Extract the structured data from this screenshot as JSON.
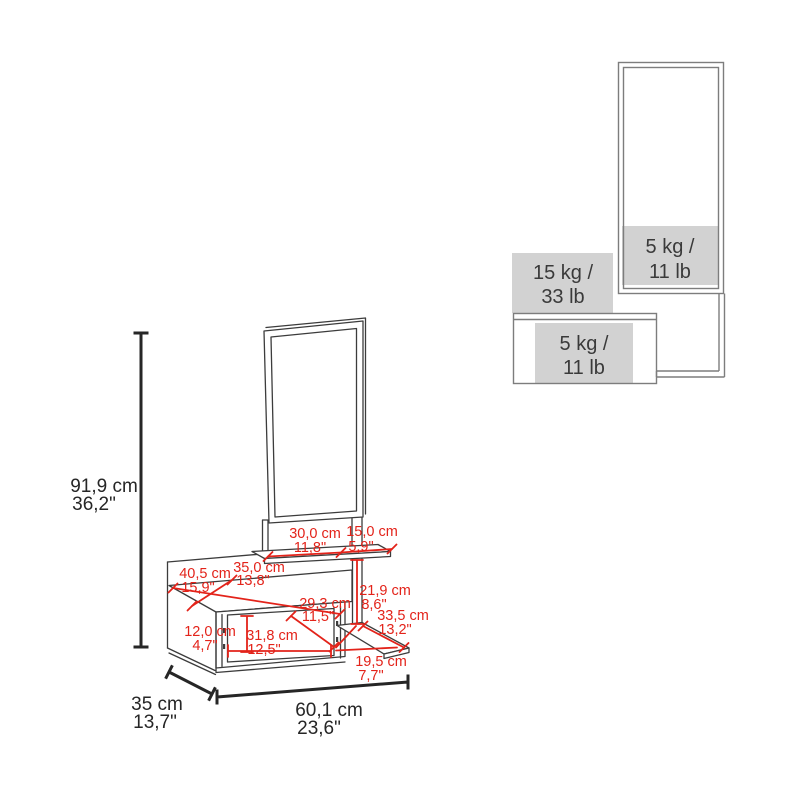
{
  "capacity_view": {
    "mirror_load": {
      "line1": "5 kg /",
      "line2": "11 lb"
    },
    "top_load": {
      "line1": "15 kg /",
      "line2": "33 lb"
    },
    "shelf_load": {
      "line1": "5 kg /",
      "line2": "11 lb"
    }
  },
  "dimension_view": {
    "height": {
      "cm": "91,9 cm",
      "in": "36,2\""
    },
    "depth": {
      "cm": "35 cm",
      "in": "13,7\""
    },
    "width": {
      "cm": "60,1 cm",
      "in": "23,6\""
    },
    "shelf_section_left": {
      "cm": "30,0 cm",
      "in": "11,8\""
    },
    "shelf_section_right": {
      "cm": "15,0 cm",
      "in": "5,9\""
    },
    "top_surface_width": {
      "cm": "40,5 cm",
      "in": "15,9\""
    },
    "top_surface_depth": {
      "cm": "35,0 cm",
      "in": "13,8\""
    },
    "right_column_height": {
      "cm": "21,9 cm",
      "in": "8,6\""
    },
    "compartment_depth": {
      "cm": "29,3 cm",
      "in": "11,5\""
    },
    "compartment_width": {
      "cm": "31,8 cm",
      "in": "12,5\""
    },
    "compartment_height": {
      "cm": "12,0 cm",
      "in": "4,7\""
    },
    "lower_shelf_diagonal": {
      "cm": "33,5 cm",
      "in": "13,2\""
    },
    "lower_shelf_depth": {
      "cm": "19,5 cm",
      "in": "7,7\""
    }
  },
  "colors": {
    "dimension_red": "#e3231a",
    "line_gray": "#7d7d7d",
    "capacity_fill": "#d2d2d2",
    "text_dark": "#3a3a3a",
    "drawing_dark": "#3c3c3c"
  }
}
